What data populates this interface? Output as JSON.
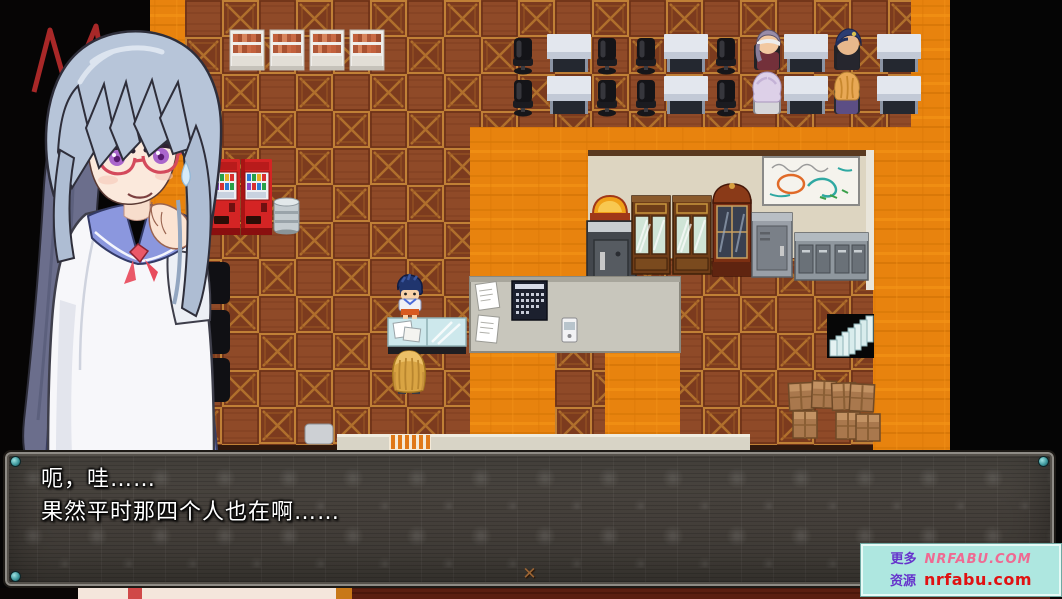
{
  "window": {
    "width": 1062,
    "height": 599,
    "app": "rpg-game-screen"
  },
  "dialogue": {
    "lines": [
      "呃，哇……",
      "果然平时那四个人也在啊……"
    ],
    "continue_icon": "✕"
  },
  "watermark": {
    "rows": [
      {
        "label": "更多",
        "site": "NRFABU.COM"
      },
      {
        "label": "资源",
        "site": "nrfabu.com"
      }
    ]
  },
  "scene_objects": [
    "bookshelf",
    "office-desk",
    "office-chair",
    "npc-purple-hair",
    "npc-blue-hat",
    "npc-lavender-hair",
    "npc-blonde",
    "vending-machine",
    "trash-can",
    "whiteboard",
    "display-cabinet",
    "tall-cupboard",
    "safe",
    "metal-locker",
    "metal-cabinet",
    "bulletin-board",
    "wall-calendar",
    "intercom",
    "paper-sheet",
    "glass-counter",
    "player-boy",
    "blonde-girl",
    "staircase-down",
    "cardboard-boxes",
    "portrait-girl"
  ],
  "colors": {
    "floor_orange": "#e8830e",
    "tile_brown": "#8f4a28",
    "crate_border": "#c08036",
    "wall_beige": "#ddd5c1",
    "dialog_bg": "#45413c",
    "dialog_border": "#8f8c86",
    "dialog_screw": "#3f9a9e",
    "dialog_text": "#ffffff",
    "watermark_bg": "#aee7e0",
    "watermark_label": "#6633cc",
    "watermark_site1": "#ef6a92",
    "watermark_site2": "#e01212",
    "portrait_hair": "#b7c5d9",
    "portrait_eyes": "#aa66cc",
    "portrait_glasses": "#d44a5c",
    "uniform_collar": "#8b97de",
    "uniform_skirt": "#7b87cd",
    "vending_machine": "#d42424"
  }
}
